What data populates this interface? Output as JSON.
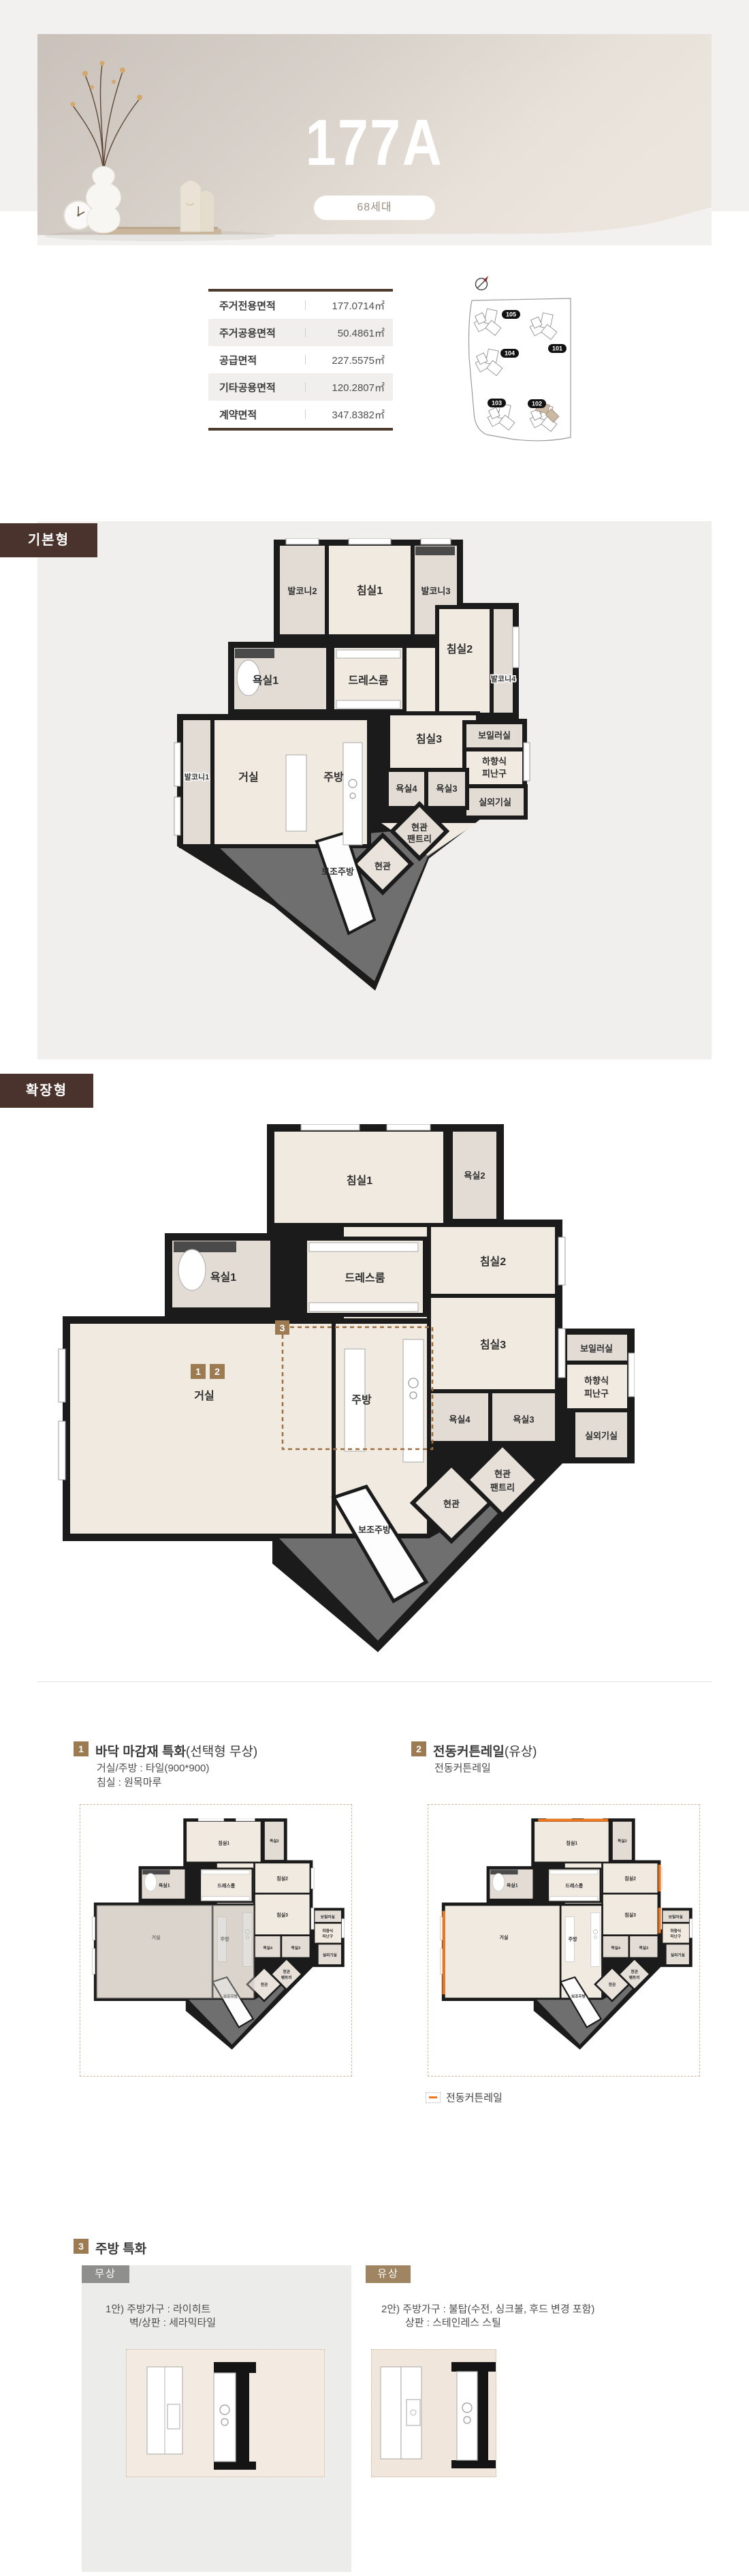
{
  "hero": {
    "title": "177A",
    "units_badge": "68세대"
  },
  "colors": {
    "brand_brown": "#4a332c",
    "marker_tan": "#9c7b53",
    "rail_orange": "#f0761e",
    "wall_black": "#1b1b1b"
  },
  "area_table": {
    "rows": [
      {
        "label": "주거전용면적",
        "value": "177.0714㎡"
      },
      {
        "label": "주거공용면적",
        "value": "50.4861㎡"
      },
      {
        "label": "공급면적",
        "value": "227.5575㎡"
      },
      {
        "label": "기타공용면적",
        "value": "120.2807㎡"
      },
      {
        "label": "계약면적",
        "value": "347.8382㎡"
      }
    ]
  },
  "site_plan": {
    "buildings": [
      "105",
      "101",
      "104",
      "103",
      "102"
    ]
  },
  "plans": {
    "basic": {
      "tag": "기본형",
      "rooms": {
        "balcony2": "발코니2",
        "bed1": "침실1",
        "balcony3": "발코니3",
        "bed2": "침실2",
        "balcony4": "발코니4",
        "bath1": "욕실1",
        "dress": "드레스룸",
        "bed3": "침실3",
        "boiler": "보일러실",
        "escape1": "하향식",
        "escape2": "피난구",
        "balcony1": "발코니1",
        "living": "거실",
        "kitchen": "주방",
        "bath4": "욕실4",
        "bath3": "욕실3",
        "ac": "실외기실",
        "pantry1": "현관",
        "pantry2": "팬트리",
        "entry": "현관",
        "subkitchen": "보조주방"
      }
    },
    "extended": {
      "tag": "확장형",
      "marker1": "1",
      "marker2": "2",
      "marker3": "3",
      "rooms": {
        "bed1": "침실1",
        "bath2": "욕실2",
        "bed2": "침실2",
        "dress": "드레스룸",
        "bath1": "욕실1",
        "bed3": "침실3",
        "boiler": "보일러실",
        "escape1": "하향식",
        "escape2": "피난구",
        "living": "거실",
        "kitchen": "주방",
        "bath4": "욕실4",
        "bath3": "욕실3",
        "ac": "실외기실",
        "pantry1": "현관",
        "pantry2": "팬트리",
        "entry": "현관",
        "subkitchen": "보조주방"
      }
    }
  },
  "features": {
    "item1": {
      "num": "1",
      "title": "바닥 마감재 특화",
      "suffix": "(선택형 무상)",
      "line1": "거실/주방 : 타일(900*900)",
      "line2": "침실 : 원목마루"
    },
    "item2": {
      "num": "2",
      "title": "전동커튼레일",
      "suffix": "(유상)",
      "line1": "전동커튼레일",
      "legend": "전동커튼레일"
    },
    "item3": {
      "num": "3",
      "title": "주방 특화",
      "free": {
        "badge": "무상",
        "line1": "1안) 주방가구 : 라이히트",
        "line2": "벽/상판 : 세라믹타일"
      },
      "paid": {
        "badge": "유상",
        "line1": "2안) 주방가구 : 불탑(수전, 싱크볼, 후드 변경 포함)",
        "line2": "상판 : 스테인레스 스틸"
      }
    }
  }
}
